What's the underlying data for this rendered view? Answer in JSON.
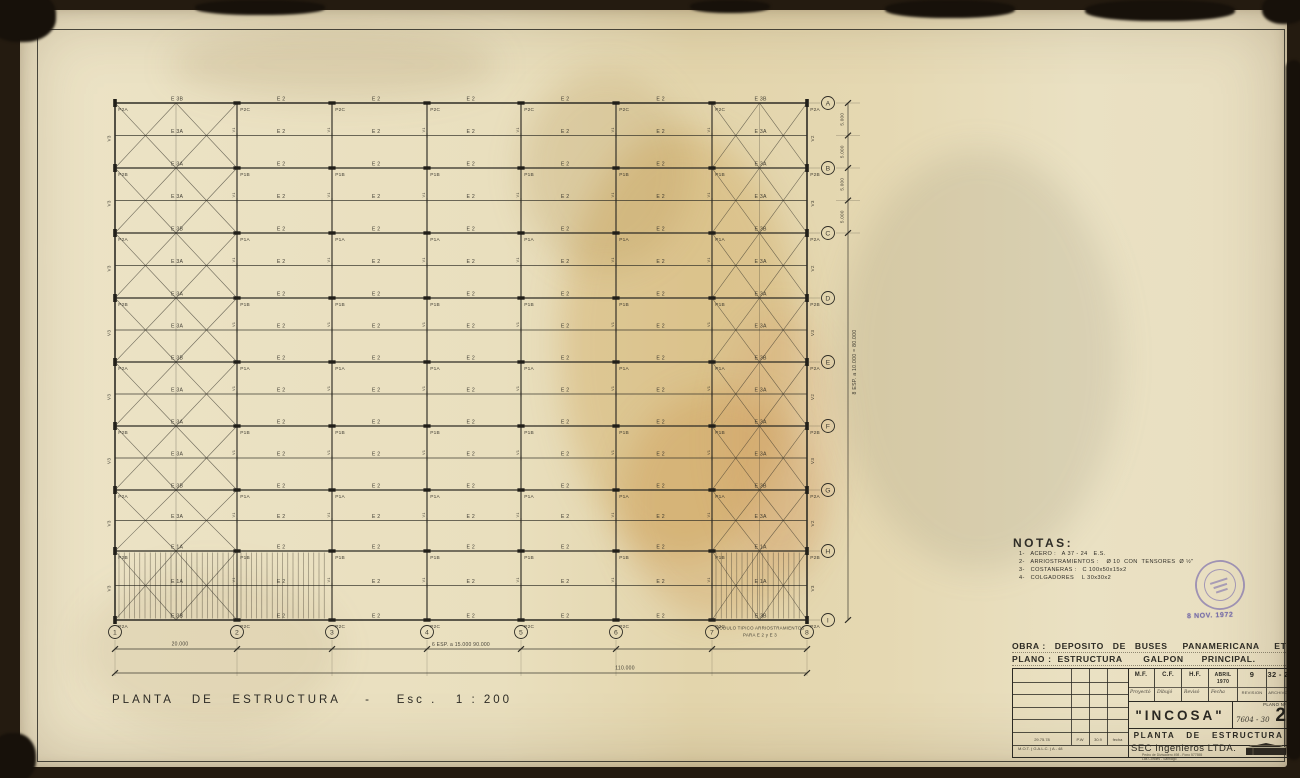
{
  "page": {
    "scan_bg": "#241b10",
    "paper": "#e9dfbe",
    "ink": "#2e2c25",
    "stamp_color": "#6f63ac"
  },
  "drawing": {
    "title": "PLANTA   DE   ESTRUCTURA    -    Esc .   1 : 200",
    "axes": {
      "cols": [
        "1",
        "2",
        "3",
        "4",
        "5",
        "6",
        "7",
        "8"
      ],
      "rows": [
        "A",
        "B",
        "C",
        "D",
        "E",
        "F",
        "G",
        "H",
        "I"
      ]
    },
    "labels": {
      "p2a": "P2A",
      "p2b": "P2B",
      "p2c": "P2C",
      "p1a": "P1A",
      "p1b": "P1B",
      "e2": "E 2",
      "e3a": "E 3A",
      "e3b": "E 3B",
      "e1a": "E 1A",
      "v1": "V1",
      "v2": "V2",
      "v3": "V3"
    },
    "dims": {
      "bottom_first": "20.000",
      "bottom_typ": "6  ESP.  a  15.000      90.000",
      "bottom_total": "110.000",
      "right_half": "5.000",
      "right_total": "8  ESP.  a  10.000  =  80.000"
    },
    "module_note_line1": "MODULO  TIPICO  ARRIOSTRAMIENTOS",
    "module_note_line2": "PARA   E 2  y  E 3"
  },
  "notas": {
    "title": "NOTAS:",
    "items": [
      "1-   ACERO :   A 37 - 24   E.S.",
      "2-   ARRIOSTRAMIENTOS :    Ø 10  CON  TENSORES  Ø ½\"",
      "3-   COSTANERAS :   C 100x50x15x2",
      "4-   COLGADORES    L 30x30x2"
    ]
  },
  "stamp": {
    "date": "8 NOV. 1972"
  },
  "title_block": {
    "obra": "OBRA :   DEPOSITO   DE   BUSES     PANAMERICANA     ETCE.",
    "plano": "PLANO :  ESTRUCTURA       GALPON      PRINCIPAL.",
    "sign_cols": [
      {
        "top": "M.F.",
        "sub": "Proyectó"
      },
      {
        "top": "C.F.",
        "sub": "Dibujó"
      },
      {
        "top": "H.F.",
        "sub": "Revisó"
      },
      {
        "top": "ABRIL 1970",
        "sub": "Fecha"
      },
      {
        "top": "9",
        "sub": "REVISION"
      },
      {
        "top": "32 - 2",
        "sub": "ARCHIVO"
      }
    ],
    "company": "\"INCOSA\"",
    "plano_no_label": "PLANO Nº",
    "plano_no": "7604 - 30",
    "sheet_no": "2",
    "drawing_title": "PLANTA   DE   ESTRUCTURA",
    "firm": "SEC Ingenieros LTDA.",
    "firm_address1": "Pedro de Divisadero 498 - Fono 577555",
    "firm_address2": "Las Condes - Santiago",
    "rev_row": [
      "29.75.78",
      "P.W",
      "30.9",
      "fecha"
    ],
    "rev_note": "M.O.T.  ( G.A.L.C. )  A - 48"
  }
}
